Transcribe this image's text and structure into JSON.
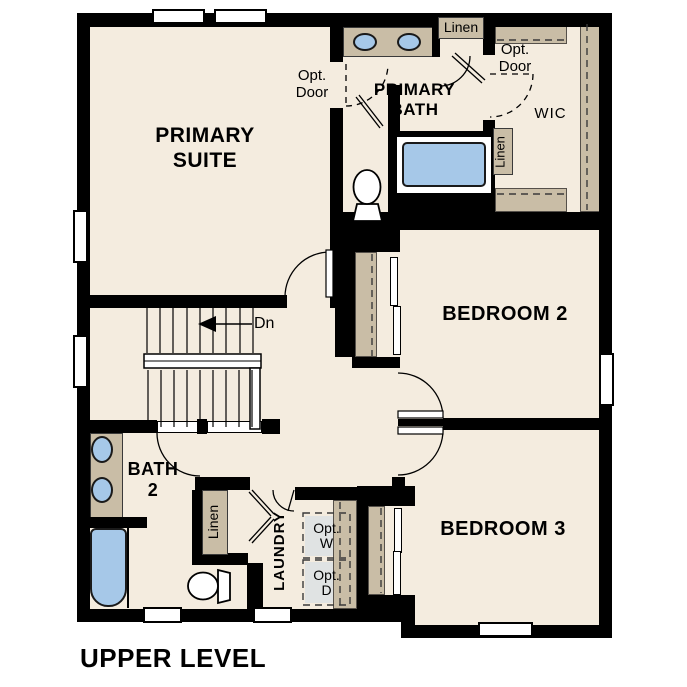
{
  "page": {
    "title": "UPPER LEVEL"
  },
  "rooms": {
    "primary_suite": {
      "line1": "PRIMARY",
      "line2": "SUITE"
    },
    "primary_bath": {
      "line1": "PRIMARY",
      "line2": "BATH"
    },
    "wic": {
      "label": "WIC"
    },
    "bedroom_2": {
      "label": "BEDROOM 2"
    },
    "bedroom_3": {
      "label": "BEDROOM 3"
    },
    "bath_2": {
      "line1": "BATH",
      "line2": "2"
    },
    "laundry": {
      "label": "LAUNDRY"
    }
  },
  "annotations": {
    "opt_door_primary": {
      "line1": "Opt.",
      "line2": "Door"
    },
    "opt_door_wic": {
      "line1": "Opt.",
      "line2": "Door"
    },
    "linen_primary_bath": "Linen",
    "linen_wic": "Linen",
    "linen_bath_2": "Linen",
    "stairs_direction": "Dn",
    "opt_washer": {
      "line1": "Opt.",
      "line2": "W"
    },
    "opt_dryer": {
      "line1": "Opt.",
      "line2": "D"
    }
  },
  "colors": {
    "floor": "#f4ecdf",
    "cabinet": "#c9bda6",
    "fixture_blue": "#a6c8e8",
    "wall": "#000000",
    "appliance": "#e0e3e3"
  }
}
